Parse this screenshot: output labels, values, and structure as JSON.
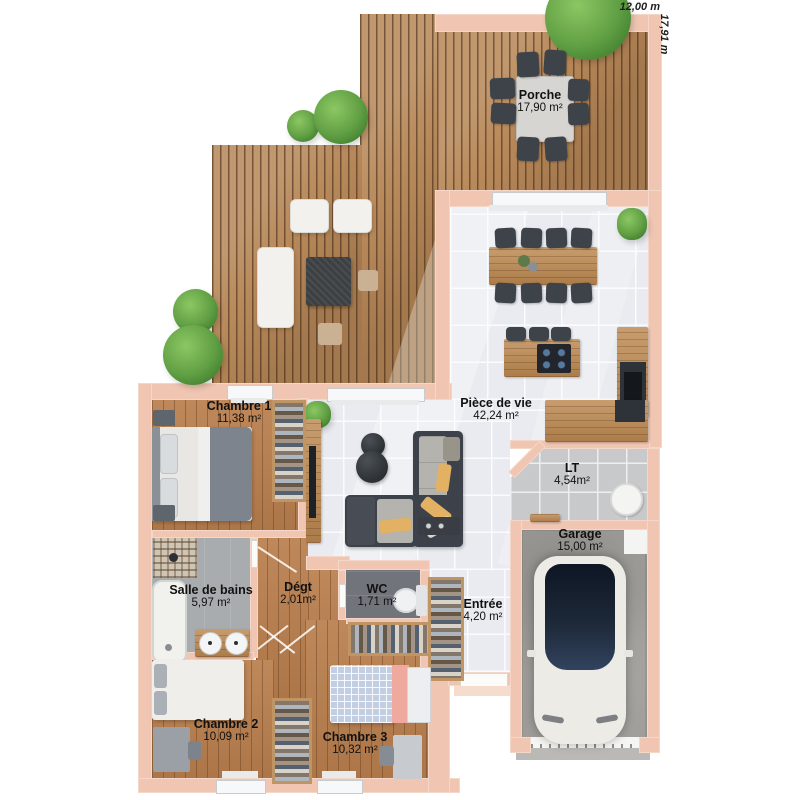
{
  "dimensions": {
    "width_label": "12,00 m",
    "height_label": "17,91 m"
  },
  "rooms": {
    "porche": {
      "name": "Porche",
      "area": "17,90 m²"
    },
    "piece_de_vie": {
      "name": "Pièce de vie",
      "area": "42,24 m²"
    },
    "chambre1": {
      "name": "Chambre 1",
      "area": "11,38 m²"
    },
    "lt": {
      "name": "LT",
      "area": "4,54m²"
    },
    "garage": {
      "name": "Garage",
      "area": "15,00 m²"
    },
    "salle_de_bains": {
      "name": "Salle de bains",
      "area": "5,97 m²"
    },
    "degt": {
      "name": "Dégt",
      "area": "2,01m²"
    },
    "wc": {
      "name": "WC",
      "area": "1,71 m²"
    },
    "entree": {
      "name": "Entrée",
      "area": "4,20 m²"
    },
    "chambre2": {
      "name": "Chambre 2",
      "area": "10,09 m²"
    },
    "chambre3": {
      "name": "Chambre 3",
      "area": "10,32 m²"
    }
  },
  "colors": {
    "wall": "#f0c6b2",
    "deck_wood": "#b8895a",
    "interior_wood": "#b97f4e",
    "tile_floor": "#e9ebf0",
    "lt_tile": "#c7c9cb",
    "garage_floor": "#9d9c98",
    "wc_floor": "#71757b",
    "tree_green": "#5f9e43",
    "accent_pillow": "#e2b163",
    "car_roof": "#1d2838",
    "label_text": "#111111"
  }
}
